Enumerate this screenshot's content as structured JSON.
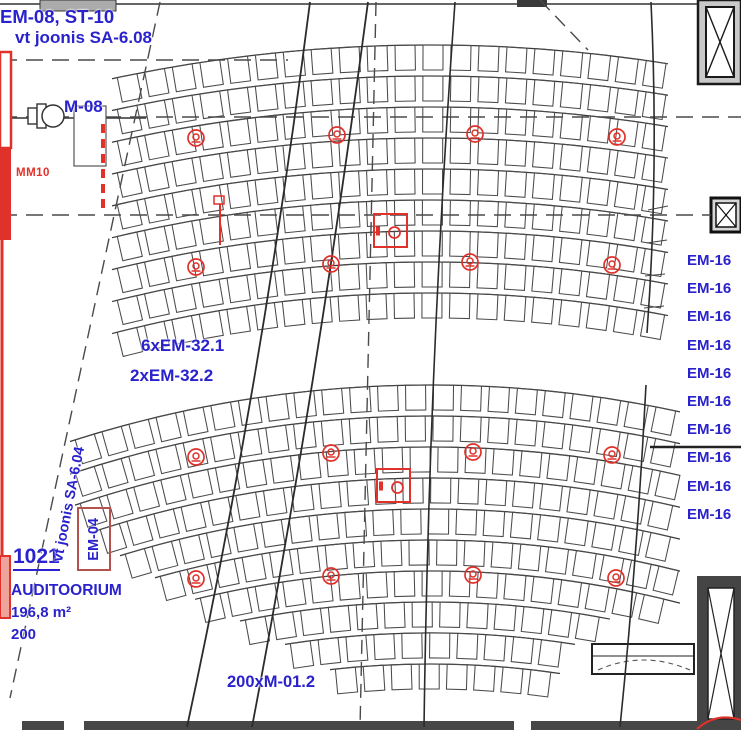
{
  "annotations": {
    "top_left_line1": "EM-08, ST-10",
    "top_left_line2": "vt joonis SA-6.08",
    "m08": "M-08",
    "mm10": "MM10",
    "em32_line1": "6xEM-32.1",
    "em32_line2": "2xEM-32.2",
    "em16_label": "EM-16",
    "em16_count": 10,
    "room_number": "1021",
    "room_name": "AUDITOORIUM",
    "room_area": "196,8 m²",
    "room_capacity": "200",
    "seat_note": "200xM-01.2",
    "vt_joonis_vertical": "vt joonis SA-6.04",
    "em04": "EM-04"
  },
  "colors": {
    "annotation_blue": "#2a22cc",
    "symbol_red": "#e0312a",
    "line_dark": "#3c3c3c",
    "wall_fill": "#474747"
  },
  "symbols": {
    "speaker_positions": [
      [
        196,
        138
      ],
      [
        337,
        135
      ],
      [
        475,
        134
      ],
      [
        617,
        137
      ],
      [
        196,
        267
      ],
      [
        331,
        264
      ],
      [
        470,
        262
      ],
      [
        612,
        265
      ],
      [
        196,
        457
      ],
      [
        331,
        453
      ],
      [
        473,
        452
      ],
      [
        612,
        455
      ],
      [
        196,
        579
      ],
      [
        331,
        576
      ],
      [
        473,
        575
      ],
      [
        616,
        578
      ]
    ],
    "floor_box_positions": [
      [
        374,
        214
      ],
      [
        377,
        469
      ]
    ],
    "floor_box_size": 33
  },
  "seating": {
    "arc_center": [
      430,
      1560
    ],
    "seat_w": 20,
    "seat_h": 25,
    "seat_pitch": 28,
    "banks": [
      {
        "r_first": 1515,
        "row_pitch": 31,
        "rows": 9,
        "xmin": [
          112,
          112,
          112,
          112,
          112,
          112,
          112,
          112,
          112
        ],
        "xmax": [
          668,
          668,
          668,
          668,
          668,
          668,
          668,
          668,
          668
        ]
      },
      {
        "r_first": 1175,
        "row_pitch": 31,
        "rows": 10,
        "xmin": [
          70,
          70,
          75,
          95,
          120,
          155,
          195,
          240,
          285,
          330
        ],
        "xmax": [
          680,
          680,
          680,
          680,
          680,
          680,
          680,
          610,
          575,
          560
        ]
      }
    ]
  }
}
